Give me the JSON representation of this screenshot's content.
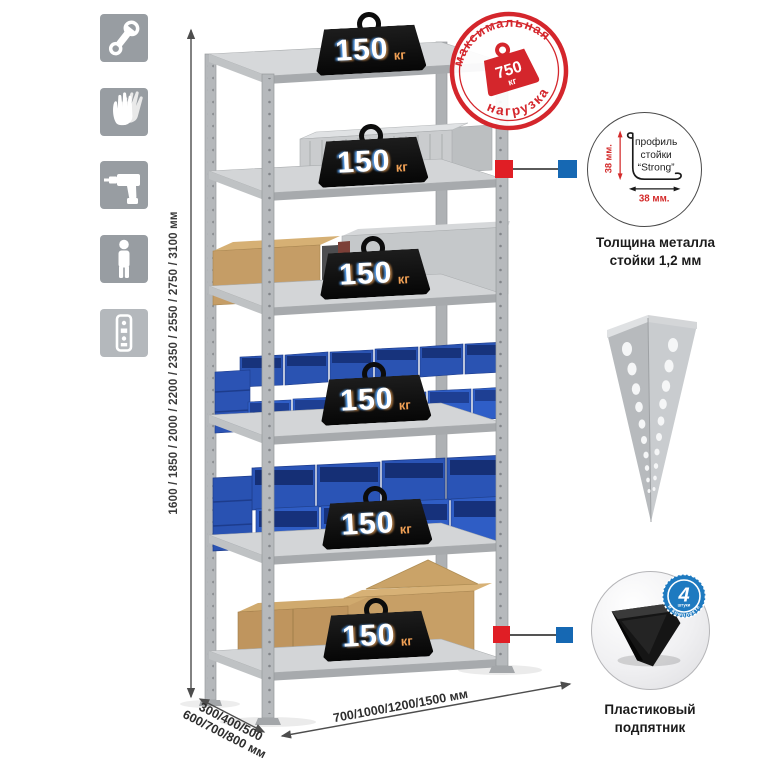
{
  "palette": {
    "stamp_red": "#d4262c",
    "marker_red": "#e01e25",
    "marker_blue": "#1668b3",
    "kit_badge_blue": "#1e7ac0",
    "bin_blue": "#2f5ec7",
    "metal_gray": "#c6c9cb",
    "icon_square_gray": "#989da2"
  },
  "left_toolbar": {
    "icons": [
      {
        "name": "wrench-icon"
      },
      {
        "name": "gloves-icon"
      },
      {
        "name": "drill-icon"
      },
      {
        "name": "person-icon"
      },
      {
        "name": "rack-profile-icon"
      }
    ]
  },
  "dimensions": {
    "height": "1600 / 1850 / 2000 / 2200 / 2350 / 2550 / 2750 / 3100 мм",
    "depth_line1": "300/400/500",
    "depth_line2": "600/700/800 мм",
    "width": "700/1000/1200/1500 мм"
  },
  "max_load_stamp": {
    "top_arc": "максимальная",
    "bottom_arc": "нагрузка",
    "value": "750",
    "unit": "кг"
  },
  "shelf_badges": [
    {
      "value": "150",
      "unit": "кг"
    },
    {
      "value": "150",
      "unit": "кг"
    },
    {
      "value": "150",
      "unit": "кг"
    },
    {
      "value": "150",
      "unit": "кг"
    },
    {
      "value": "150",
      "unit": "кг"
    },
    {
      "value": "150",
      "unit": "кг"
    }
  ],
  "post_profile_detail": {
    "label_line1": "профиль",
    "label_line2": "стойки",
    "label_line3": "“Strong”",
    "vertical_dim": "38 мм.",
    "horizontal_dim": "38 мм.",
    "caption_line1": "Толщина металла",
    "caption_line2": "стойки 1,2 мм"
  },
  "foot_detail": {
    "kit_count": "4",
    "kit_count_sub": "штуки",
    "kit_arc": "в комплекте",
    "caption_line1": "Пластиковый",
    "caption_line2": "подпятник"
  }
}
